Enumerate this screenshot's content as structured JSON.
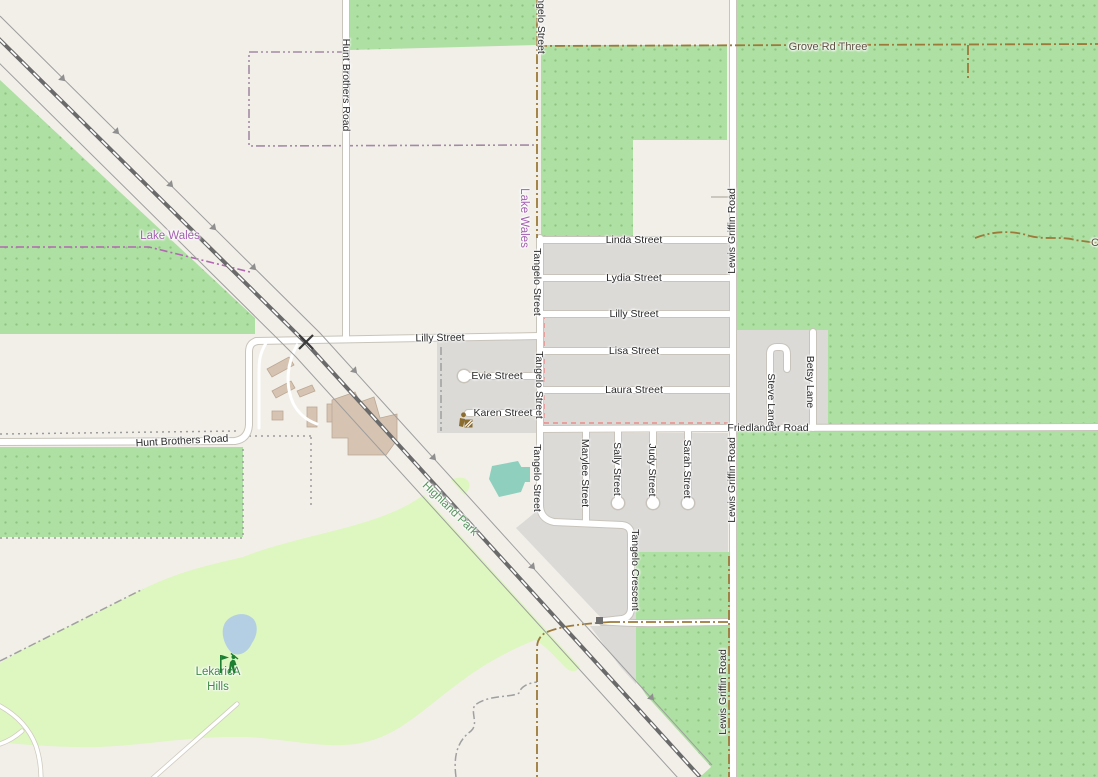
{
  "map": {
    "roads": {
      "hunt_brothers": "Hunt Brothers Road",
      "tangelo_street": "Tangelo Street",
      "lewis_griffin": "Lewis Griffin Road",
      "grove_rd_three": "Grove Rd Three",
      "linda": "Linda Street",
      "lydia": "Lydia Street",
      "lilly": "Lilly Street",
      "lisa": "Lisa Street",
      "laura": "Laura Street",
      "evie": "Evie Street",
      "karen": "Karen Street",
      "friedlander": "Friedlander Road",
      "betsy": "Betsy Lane",
      "steve": "Steve Lane",
      "marylee": "Marylee Street",
      "sally": "Sally Street",
      "judy": "Judy Street",
      "sarah": "Sarah Street",
      "tangelo_crescent": "Tangelo Crescent",
      "truncated_east": "C"
    },
    "places": {
      "lake_wales": "Lake Wales",
      "highland_park": "Highland Park",
      "golf_name_line1": "LekaricA",
      "golf_name_line2": "Hills"
    },
    "icons": [
      "golfer-icon",
      "level-crossing-icon",
      "railway-crossing-square-icon",
      "karen-street-poi-icon",
      "one-way-arrow-icon"
    ],
    "colors": {
      "base": "#f2efe9",
      "orchard": "#aedfa3",
      "orchard_dot": "#8cc480",
      "golf": "#def6c0",
      "residential": "#dbdad7",
      "water": "#b4cfe4",
      "pitch": "#8ed0bd",
      "building": "#d6c3b2",
      "building_stroke": "#bba894",
      "road_fill": "#ffffff",
      "road_casing": "#c8c4bb",
      "railway": "#6a6a6a",
      "track": "#9c7a3a",
      "boundary_gray": "#a0a0a0",
      "boundary_mauve": "#a28ba5",
      "boundary_purple": "#b069b0",
      "boundary_red": "#e98c8c",
      "street_label": "#2a2a2a",
      "track_label": "#5b5242",
      "place_label": "#a35fb0",
      "park_label": "#55945c",
      "golf_label": "#3f8a46"
    }
  }
}
